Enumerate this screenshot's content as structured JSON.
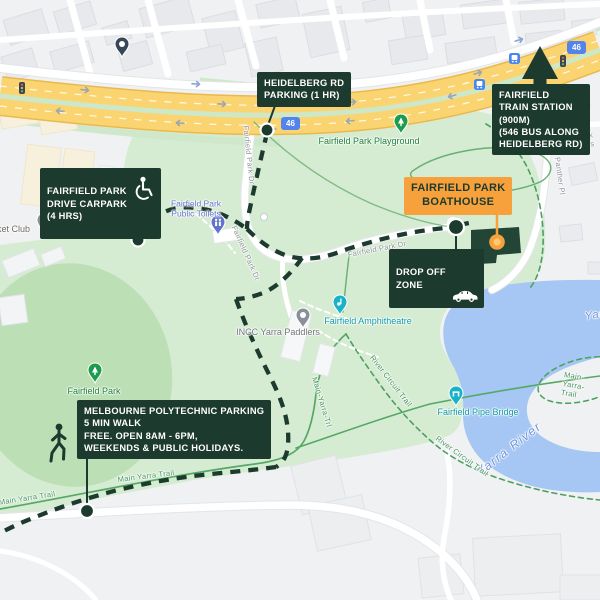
{
  "map_title": "Fairfield Park Boathouse access and parking map",
  "colors": {
    "callout_dark_green": "#1d3a2e",
    "boathouse_orange": "#f6a13c",
    "route_badge_blue": "#5383ec",
    "water_blue": "#a6c7f4",
    "park_green": "#d6ecd2",
    "oval_green": "#bcdfb6",
    "main_road_yellow": "#fbd472",
    "trail_green": "#55a866"
  },
  "callouts": {
    "heidelberg_parking": {
      "text": "HEIDELBERG RD\nPARKING (1 HR)"
    },
    "train_station": {
      "text": "FAIRFIELD\nTRAIN STATION\n(900M)\n(546 BUS ALONG\nHEIDELBERG RD)"
    },
    "drive_carpark": {
      "text": "FAIRFIELD PARK\nDRIVE CARPARK\n(4 HRS)"
    },
    "boathouse": {
      "text": "FAIRFIELD PARK\nBOATHOUSE"
    },
    "drop_off": {
      "text": "DROP OFF\nZONE"
    },
    "polytechnic": {
      "text": "MELBOURNE POLYTECHNIC PARKING\n5 MIN WALK\nFREE. OPEN 8AM - 6PM,\nWEEKENDS & PUBLIC HOLIDAYS."
    }
  },
  "poi_labels": {
    "playground": "Fairfield Park Playground",
    "cricket_club": "Cricket Club",
    "toilets": "Fairfield Park\nPublic Toilets",
    "amphitheatre": "Fairfield Amphitheatre",
    "incc": "INCC Yarra Paddlers",
    "fairfield_park": "Fairfield Park",
    "pipe_bridge": "Fairfield Pipe Bridge"
  },
  "water_labels": {
    "yarra_river": "Yarra River",
    "yarra_partial": "Yarra"
  },
  "street_labels": {
    "fairfield_park_dr": "Fairfield Park Dr",
    "panther_pl": "Panther Pl",
    "park_cres": "Park Cres"
  },
  "trail_labels": {
    "main_yarra": "Main Yarra Trail",
    "main_yarra_short": "Main-Yarra-Trl",
    "main_yarra_hyphen": "Main-Yarra-Trail",
    "river_circuit": "River Circuit Trail"
  },
  "road_badges": [
    {
      "label": "46"
    },
    {
      "label": "46"
    }
  ]
}
